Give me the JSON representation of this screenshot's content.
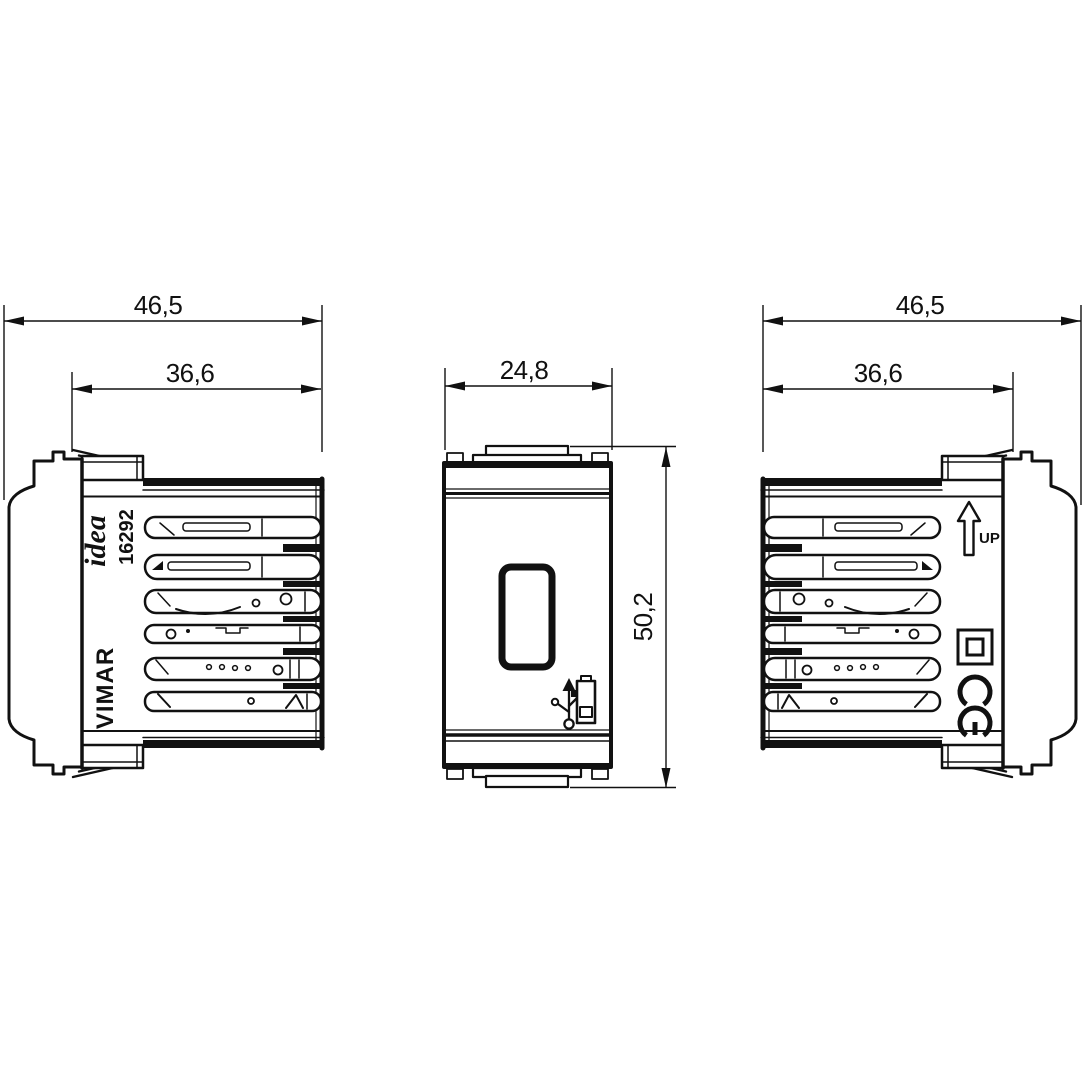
{
  "page": {
    "background": "#ffffff",
    "ink": "#111111"
  },
  "drawing": {
    "type": "technical-dimensional-drawing",
    "views": [
      {
        "id": "left-side-view",
        "dimensions": [
          {
            "name": "overall-depth",
            "label": "46,5"
          },
          {
            "name": "recessed-depth",
            "label": "36,6"
          }
        ],
        "markings": {
          "series_logo": "idea",
          "article_number": "16292",
          "brand": "VIMAR"
        }
      },
      {
        "id": "front-view",
        "dimensions": [
          {
            "name": "module-width",
            "label": "24,8"
          },
          {
            "name": "module-height",
            "label": "50,2"
          }
        ],
        "features": [
          "usb-a-port",
          "usb-charging-icon"
        ]
      },
      {
        "id": "right-side-view",
        "dimensions": [
          {
            "name": "overall-depth",
            "label": "46,5"
          },
          {
            "name": "recessed-depth",
            "label": "36,6"
          }
        ],
        "markings": {
          "orientation_label": "UP",
          "icons": [
            "up-arrow-icon",
            "double-insulation-icon",
            "ce-mark-icon"
          ]
        }
      }
    ]
  }
}
